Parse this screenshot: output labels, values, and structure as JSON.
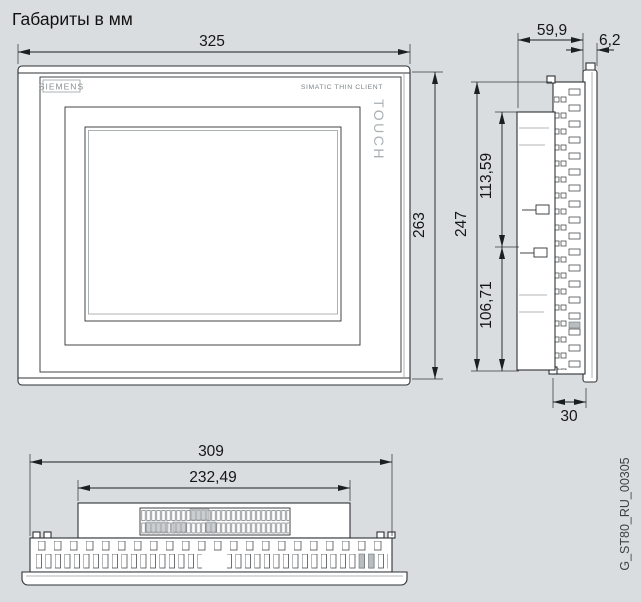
{
  "title": "Габариты в мм",
  "drawing_code": "G_ST80_RU_00305",
  "device": {
    "brand": "SIEMENS",
    "product_line": "SIMATIC THIN CLIENT",
    "panel_type": "TOUCH"
  },
  "dimensions_mm": {
    "front": {
      "width": "325",
      "height": "263"
    },
    "side": {
      "depth_without_bezel": "59,9",
      "bezel_thickness": "6,2",
      "total_height": "247",
      "upper_section": "113,59",
      "lower_section": "106,71",
      "rear_depth": "30"
    },
    "bottom": {
      "housing_width": "309",
      "rear_housing_width": "232,49"
    }
  },
  "colors": {
    "background": "#dadde0",
    "line": "#2d3134",
    "surface": "#ffffff",
    "muted_text": "#8a9094"
  }
}
